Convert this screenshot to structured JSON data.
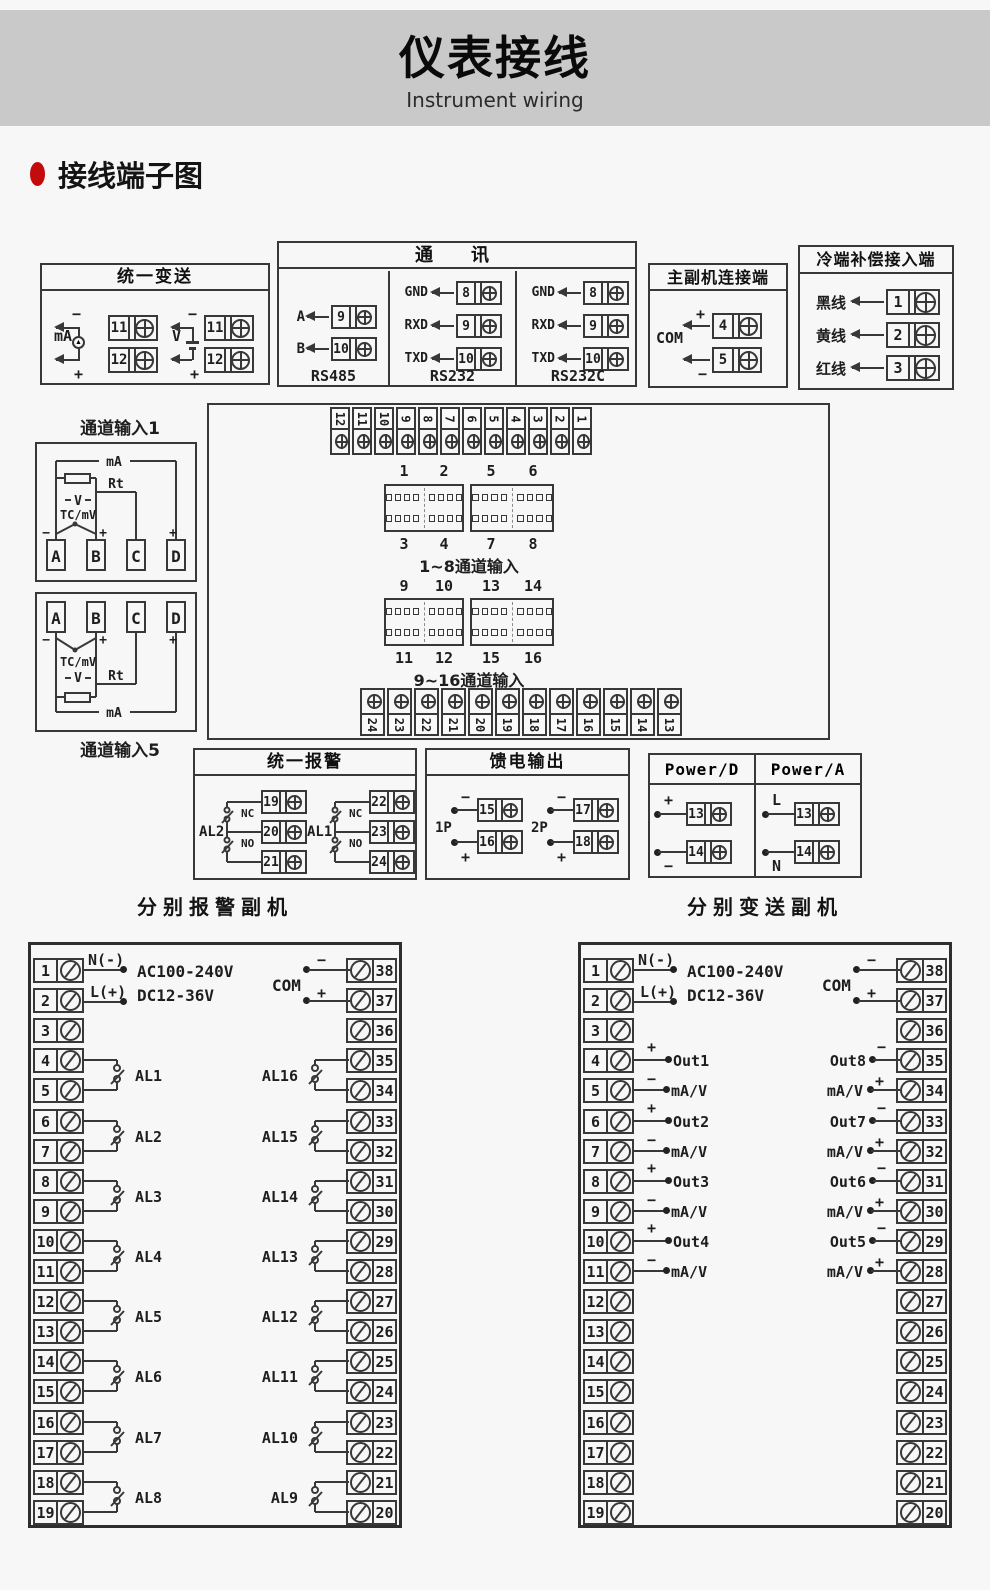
{
  "banner": {
    "title": "仪表接线",
    "subtitle": "Instrument wiring"
  },
  "section": {
    "title": "接线端子图"
  },
  "unified_transmit": {
    "title": "统一变送",
    "ma": "mA",
    "v": "V",
    "minus": "−",
    "plus": "+",
    "ma_t1": "11",
    "ma_t2": "12",
    "v_t1": "11",
    "v_t2": "12"
  },
  "comm": {
    "title": "通　讯",
    "rs485": {
      "name": "RS485",
      "r1l": "A",
      "r1n": "9",
      "r2l": "B",
      "r2n": "10"
    },
    "rs232": {
      "name": "RS232",
      "r1l": "GND",
      "r1n": "8",
      "r2l": "RXD",
      "r2n": "9",
      "r3l": "TXD",
      "r3n": "10"
    },
    "rs232c": {
      "name": "RS232C",
      "r1l": "GND",
      "r1n": "8",
      "r2l": "RXD",
      "r2n": "9",
      "r3l": "TXD",
      "r3n": "10"
    }
  },
  "master_slave": {
    "title": "主副机连接端",
    "com": "COM",
    "plus": "+",
    "minus": "−",
    "t1": "4",
    "t2": "5"
  },
  "cold_junction": {
    "title": "冷端补偿接入端",
    "r1l": "黑线",
    "r1n": "1",
    "r2l": "黄线",
    "r2n": "2",
    "r3l": "红线",
    "r3n": "3"
  },
  "channel1": {
    "title": "通道输入1",
    "ma": "mA",
    "rt": "Rt",
    "v": "V",
    "tc": "TC/mV",
    "minus": "−",
    "plusb": "+",
    "plusd": "+",
    "a": "A",
    "b": "B",
    "c": "C",
    "d": "D"
  },
  "channel5": {
    "title": "通道输入5",
    "ma": "mA",
    "rt": "Rt",
    "v": "V",
    "tc": "TC/mV",
    "minus": "−",
    "plusb": "+",
    "plusd": "+",
    "a": "A",
    "b": "B",
    "c": "C",
    "d": "D"
  },
  "center": {
    "top_strip": [
      "12",
      "11",
      "10",
      "9",
      "8",
      "7",
      "6",
      "5",
      "4",
      "3",
      "2",
      "1"
    ],
    "bottom_strip": [
      "24",
      "23",
      "22",
      "21",
      "20",
      "19",
      "18",
      "17",
      "16",
      "15",
      "14",
      "13"
    ],
    "row1": {
      "top": [
        "1",
        "2",
        "5",
        "6"
      ],
      "bottom": [
        "3",
        "4",
        "7",
        "8"
      ],
      "caption": "1~8通道输入"
    },
    "row2": {
      "top": [
        "9",
        "10",
        "13",
        "14"
      ],
      "bottom": [
        "11",
        "12",
        "15",
        "16"
      ],
      "caption": "9~16通道输入"
    }
  },
  "unified_alarm": {
    "title": "统一报警",
    "g1": {
      "name": "AL2",
      "nc": "NC",
      "no": "NO",
      "t1": "19",
      "t2": "20",
      "t3": "21"
    },
    "g2": {
      "name": "AL1",
      "nc": "NC",
      "no": "NO",
      "t1": "22",
      "t2": "23",
      "t3": "24"
    }
  },
  "feed": {
    "title": "馈电输出",
    "g1": {
      "name": "1P",
      "minus": "−",
      "plus": "+",
      "t1": "15",
      "t2": "16"
    },
    "g2": {
      "name": "2P",
      "minus": "−",
      "plus": "+",
      "t1": "17",
      "t2": "18"
    }
  },
  "power": {
    "d": {
      "title": "Power/D",
      "r1l": "+",
      "r1n": "13",
      "r2l": "−",
      "r2n": "14"
    },
    "a": {
      "title": "Power/A",
      "r1l": "L",
      "r1n": "13",
      "r2l": "N",
      "r2n": "14"
    }
  },
  "alarm_slave": {
    "title": "分别报警副机",
    "n_label": "N(-)",
    "l_label": "L(+)",
    "ac": "AC100-240V",
    "dc": "DC12-36V",
    "com": "COM",
    "minus": "−",
    "plus": "+",
    "left_terminals": [
      "1",
      "2",
      "3",
      "4",
      "5",
      "6",
      "7",
      "8",
      "9",
      "10",
      "11",
      "12",
      "13",
      "14",
      "15",
      "16",
      "17",
      "18",
      "19"
    ],
    "right_terminals": [
      "38",
      "37",
      "36",
      "35",
      "34",
      "33",
      "32",
      "31",
      "30",
      "29",
      "28",
      "27",
      "26",
      "25",
      "24",
      "23",
      "22",
      "21",
      "20"
    ],
    "left_groups": [
      "AL1",
      "AL2",
      "AL3",
      "AL4",
      "AL5",
      "AL6",
      "AL7",
      "AL8"
    ],
    "right_groups": [
      "AL16",
      "AL15",
      "AL14",
      "AL13",
      "AL12",
      "AL11",
      "AL10",
      "AL9"
    ]
  },
  "transmit_slave": {
    "title": "分别变送副机",
    "n_label": "N(-)",
    "l_label": "L(+)",
    "ac": "AC100-240V",
    "dc": "DC12-36V",
    "com": "COM",
    "minus": "−",
    "plus": "+",
    "left_terminals": [
      "1",
      "2",
      "3",
      "4",
      "5",
      "6",
      "7",
      "8",
      "9",
      "10",
      "11",
      "12",
      "13",
      "14",
      "15",
      "16",
      "17",
      "18",
      "19"
    ],
    "right_terminals": [
      "38",
      "37",
      "36",
      "35",
      "34",
      "33",
      "32",
      "31",
      "30",
      "29",
      "28",
      "27",
      "26",
      "25",
      "24",
      "23",
      "22",
      "21",
      "20"
    ],
    "left_outputs": [
      {
        "name": "Out1",
        "sub": "mA/V"
      },
      {
        "name": "Out2",
        "sub": "mA/V"
      },
      {
        "name": "Out3",
        "sub": "mA/V"
      },
      {
        "name": "Out4",
        "sub": "mA/V"
      }
    ],
    "right_outputs": [
      {
        "name": "Out8",
        "sub": "mA/V"
      },
      {
        "name": "Out7",
        "sub": "mA/V"
      },
      {
        "name": "Out6",
        "sub": "mA/V"
      },
      {
        "name": "Out5",
        "sub": "mA/V"
      }
    ]
  }
}
